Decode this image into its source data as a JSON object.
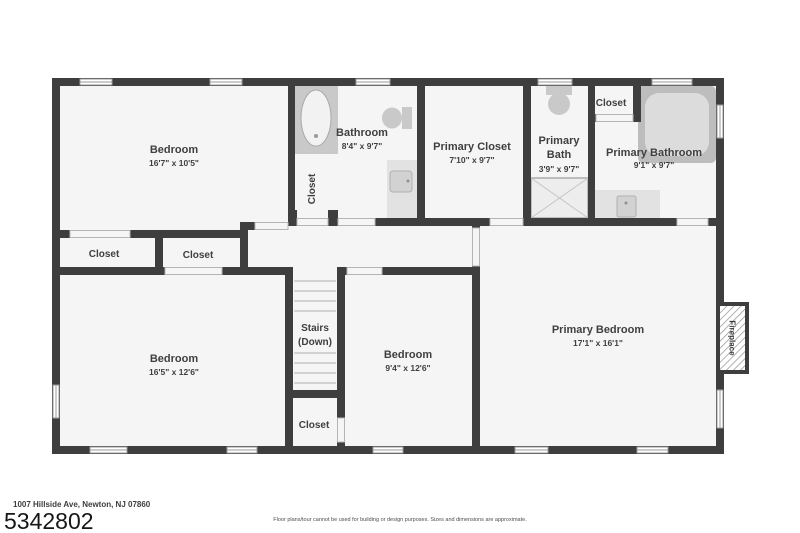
{
  "plan": {
    "rooms": {
      "bedroom_top": {
        "name": "Bedroom",
        "dims": "16'7\" x 10'5\""
      },
      "bathroom": {
        "name": "Bathroom",
        "dims": "8'4\" x 9'7\""
      },
      "bathroom_closet": {
        "name": "Closet"
      },
      "primary_closet": {
        "name": "Primary Closet",
        "dims": "7'10\" x 9'7\""
      },
      "primary_bath": {
        "name_line1": "Primary",
        "name_line2": "Bath",
        "dims": "3'9\" x 9'7\""
      },
      "hall_closet": {
        "name": "Closet"
      },
      "primary_bathroom": {
        "name": "Primary Bathroom",
        "dims": "9'1\" x 9'7\""
      },
      "closet_left": {
        "name": "Closet"
      },
      "closet_mid": {
        "name": "Closet"
      },
      "bedroom_bottom_left": {
        "name": "Bedroom",
        "dims": "16'5\" x 12'6\""
      },
      "stairs": {
        "name_line1": "Stairs",
        "name_line2": "(Down)"
      },
      "bedroom_middle": {
        "name": "Bedroom",
        "dims": "9'4\" x 12'6\""
      },
      "stairs_closet": {
        "name": "Closet"
      },
      "primary_bedroom": {
        "name": "Primary Bedroom",
        "dims": "17'1\" x 16'1\""
      },
      "fireplace": {
        "name": "Fireplace"
      }
    },
    "colors": {
      "wall": "#3e3e3e",
      "floor": "#f5f5f5",
      "fixture": "#c9c9c9",
      "label_text": "#3f3f3f"
    }
  },
  "footer": {
    "address": "1007 Hillside Ave, Newton, NJ 07860",
    "listing_number": "5342802",
    "disclaimer": "Floor plans/tour cannot be used for building or design purposes. Sizes and dimensions are approximate."
  }
}
